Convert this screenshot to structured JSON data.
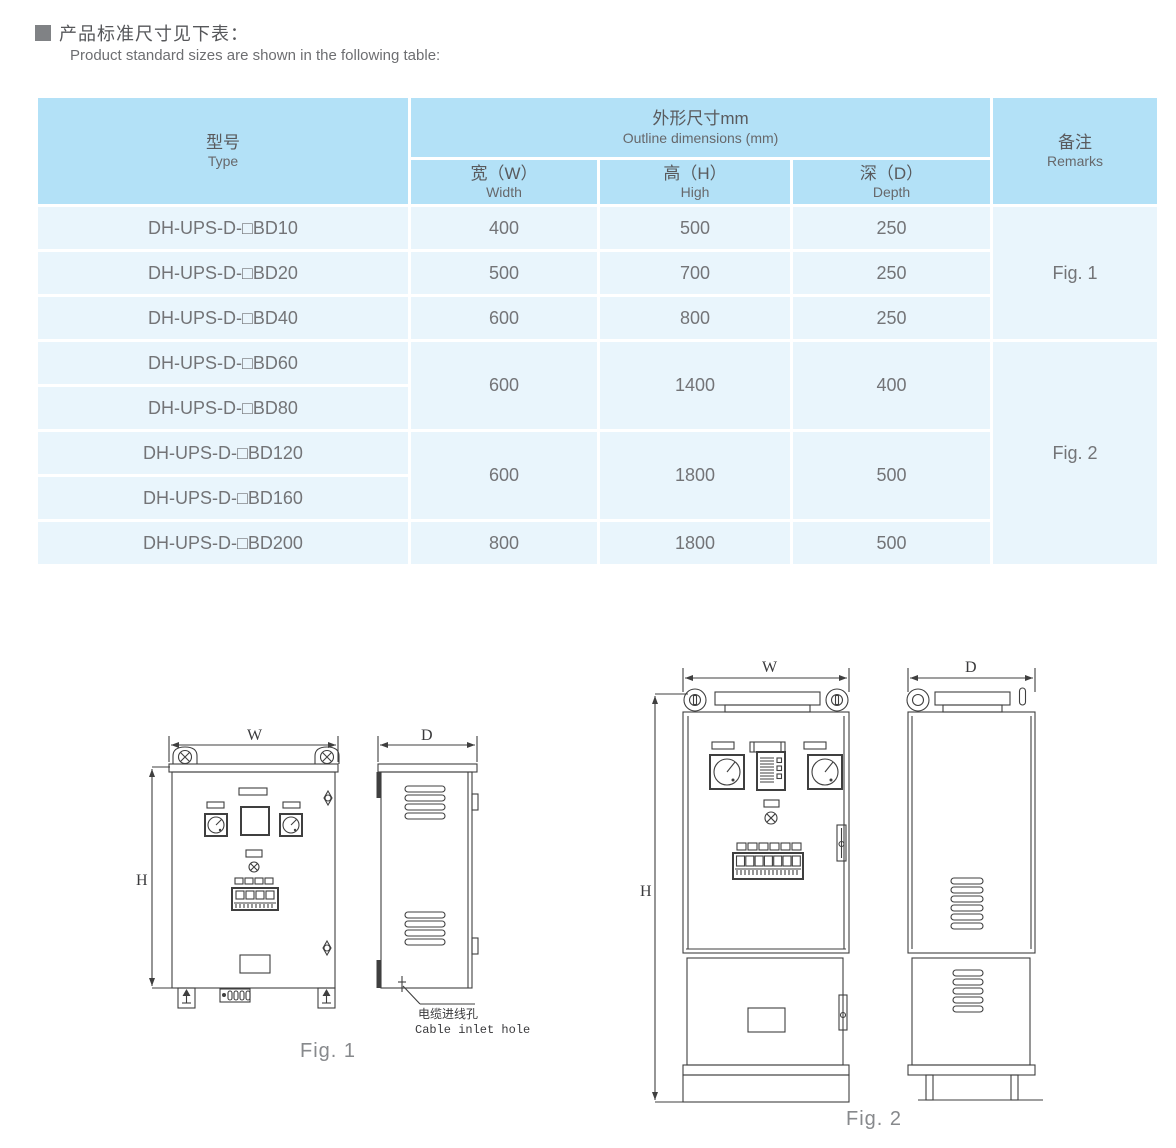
{
  "header": {
    "title_zh": "产品标准尺寸见下表：",
    "title_en": "Product standard sizes are shown in the following table:"
  },
  "table": {
    "header": {
      "type_zh": "型号",
      "type_en": "Type",
      "outline_zh": "外形尺寸mm",
      "outline_en": "Outline dimensions (mm)",
      "width_zh": "宽（W）",
      "width_en": "Width",
      "high_zh": "高（H）",
      "high_en": "High",
      "depth_zh": "深（D）",
      "depth_en": "Depth",
      "remarks_zh": "备注",
      "remarks_en": "Remarks"
    },
    "rows": [
      {
        "type": "DH-UPS-D-□BD10",
        "w": "400",
        "h": "500",
        "d": "250"
      },
      {
        "type": "DH-UPS-D-□BD20",
        "w": "500",
        "h": "700",
        "d": "250"
      },
      {
        "type": "DH-UPS-D-□BD40",
        "w": "600",
        "h": "800",
        "d": "250"
      },
      {
        "type": "DH-UPS-D-□BD60"
      },
      {
        "type": "DH-UPS-D-□BD80"
      },
      {
        "type": "DH-UPS-D-□BD120"
      },
      {
        "type": "DH-UPS-D-□BD160"
      },
      {
        "type": "DH-UPS-D-□BD200",
        "w": "800",
        "h": "1800",
        "d": "500"
      }
    ],
    "merged": {
      "g1": {
        "w": "600",
        "h": "1400",
        "d": "400"
      },
      "g2": {
        "w": "600",
        "h": "1800",
        "d": "500"
      }
    },
    "remarks": {
      "fig1": "Fig. 1",
      "fig2": "Fig. 2"
    }
  },
  "figures": {
    "fig1": {
      "caption": "Fig. 1",
      "dim_w": "W",
      "dim_h": "H",
      "dim_d": "D",
      "cable_label_zh": "电缆进线孔",
      "cable_label_en": "Cable inlet hole"
    },
    "fig2": {
      "caption": "Fig. 2",
      "dim_w": "W",
      "dim_h": "H",
      "dim_d": "D"
    }
  },
  "colors": {
    "header_bg": "#b3e1f7",
    "row_bg": "#e9f5fc",
    "drawing_line": "#3f3f3f",
    "body_text": "#737477"
  }
}
